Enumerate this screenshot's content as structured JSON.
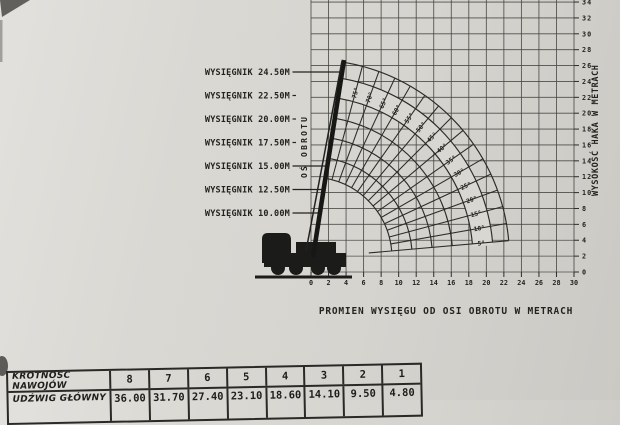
{
  "photo": {
    "paper_color": "#d9d7d2",
    "ink_color": "#2c2b28",
    "description": "scanned page of a crane load chart"
  },
  "chart_data": {
    "type": "crane-range-diagram",
    "boom_labels": [
      "WYSIĘGNIK 24.50M",
      "WYSIĘGNIK 22.50M",
      "WYSIĘGNIK 20.00M",
      "WYSIĘGNIK 17.50M",
      "WYSIĘGNIK 15.00M",
      "WYSIĘGNIK 12.50M",
      "WYSIĘGNIK 10.00M"
    ],
    "boom_lengths_m": [
      24.5,
      22.5,
      20.0,
      17.5,
      15.0,
      12.5,
      10.0
    ],
    "boom_angle_ticks_deg": [
      5,
      10,
      15,
      20,
      25,
      30,
      35,
      40,
      45,
      50,
      55,
      60,
      65,
      70,
      75
    ],
    "boom_angle_labels": [
      "5°",
      "10°",
      "15°",
      "20°",
      "25°",
      "30°",
      "35°",
      "40°",
      "45°",
      "50°",
      "55°",
      "60°",
      "65°",
      "70°",
      "75°"
    ],
    "boom_max_angle_deg": 80,
    "rotation_axis_label": "OŚ OBROTU",
    "x_axis": {
      "label": "PROMIEN WYSIĘGU OD OSI OBROTU W METRACH",
      "min": 0,
      "max": 30,
      "step": 2,
      "ticks": [
        0,
        2,
        4,
        6,
        8,
        10,
        12,
        14,
        16,
        18,
        20,
        22,
        24,
        26,
        28,
        30
      ]
    },
    "y_axis": {
      "label": "WYSOKOŚĆ HAKA W METRACH",
      "min": 0,
      "max": 34,
      "step": 2,
      "ticks": [
        0,
        2,
        4,
        6,
        8,
        10,
        12,
        14,
        16,
        18,
        20,
        22,
        24,
        26,
        28,
        30,
        32,
        34
      ]
    }
  },
  "table": {
    "rows": [
      {
        "label": "KROTNOŚĆ NAWOJÓW",
        "values": [
          "8",
          "7",
          "6",
          "5",
          "4",
          "3",
          "2",
          "1"
        ]
      },
      {
        "label": "UDŹWIG GŁÓWNY",
        "values": [
          "36.00",
          "31.70",
          "27.40",
          "23.10",
          "18.60",
          "14.10",
          "9.50",
          "4.80"
        ]
      }
    ]
  }
}
